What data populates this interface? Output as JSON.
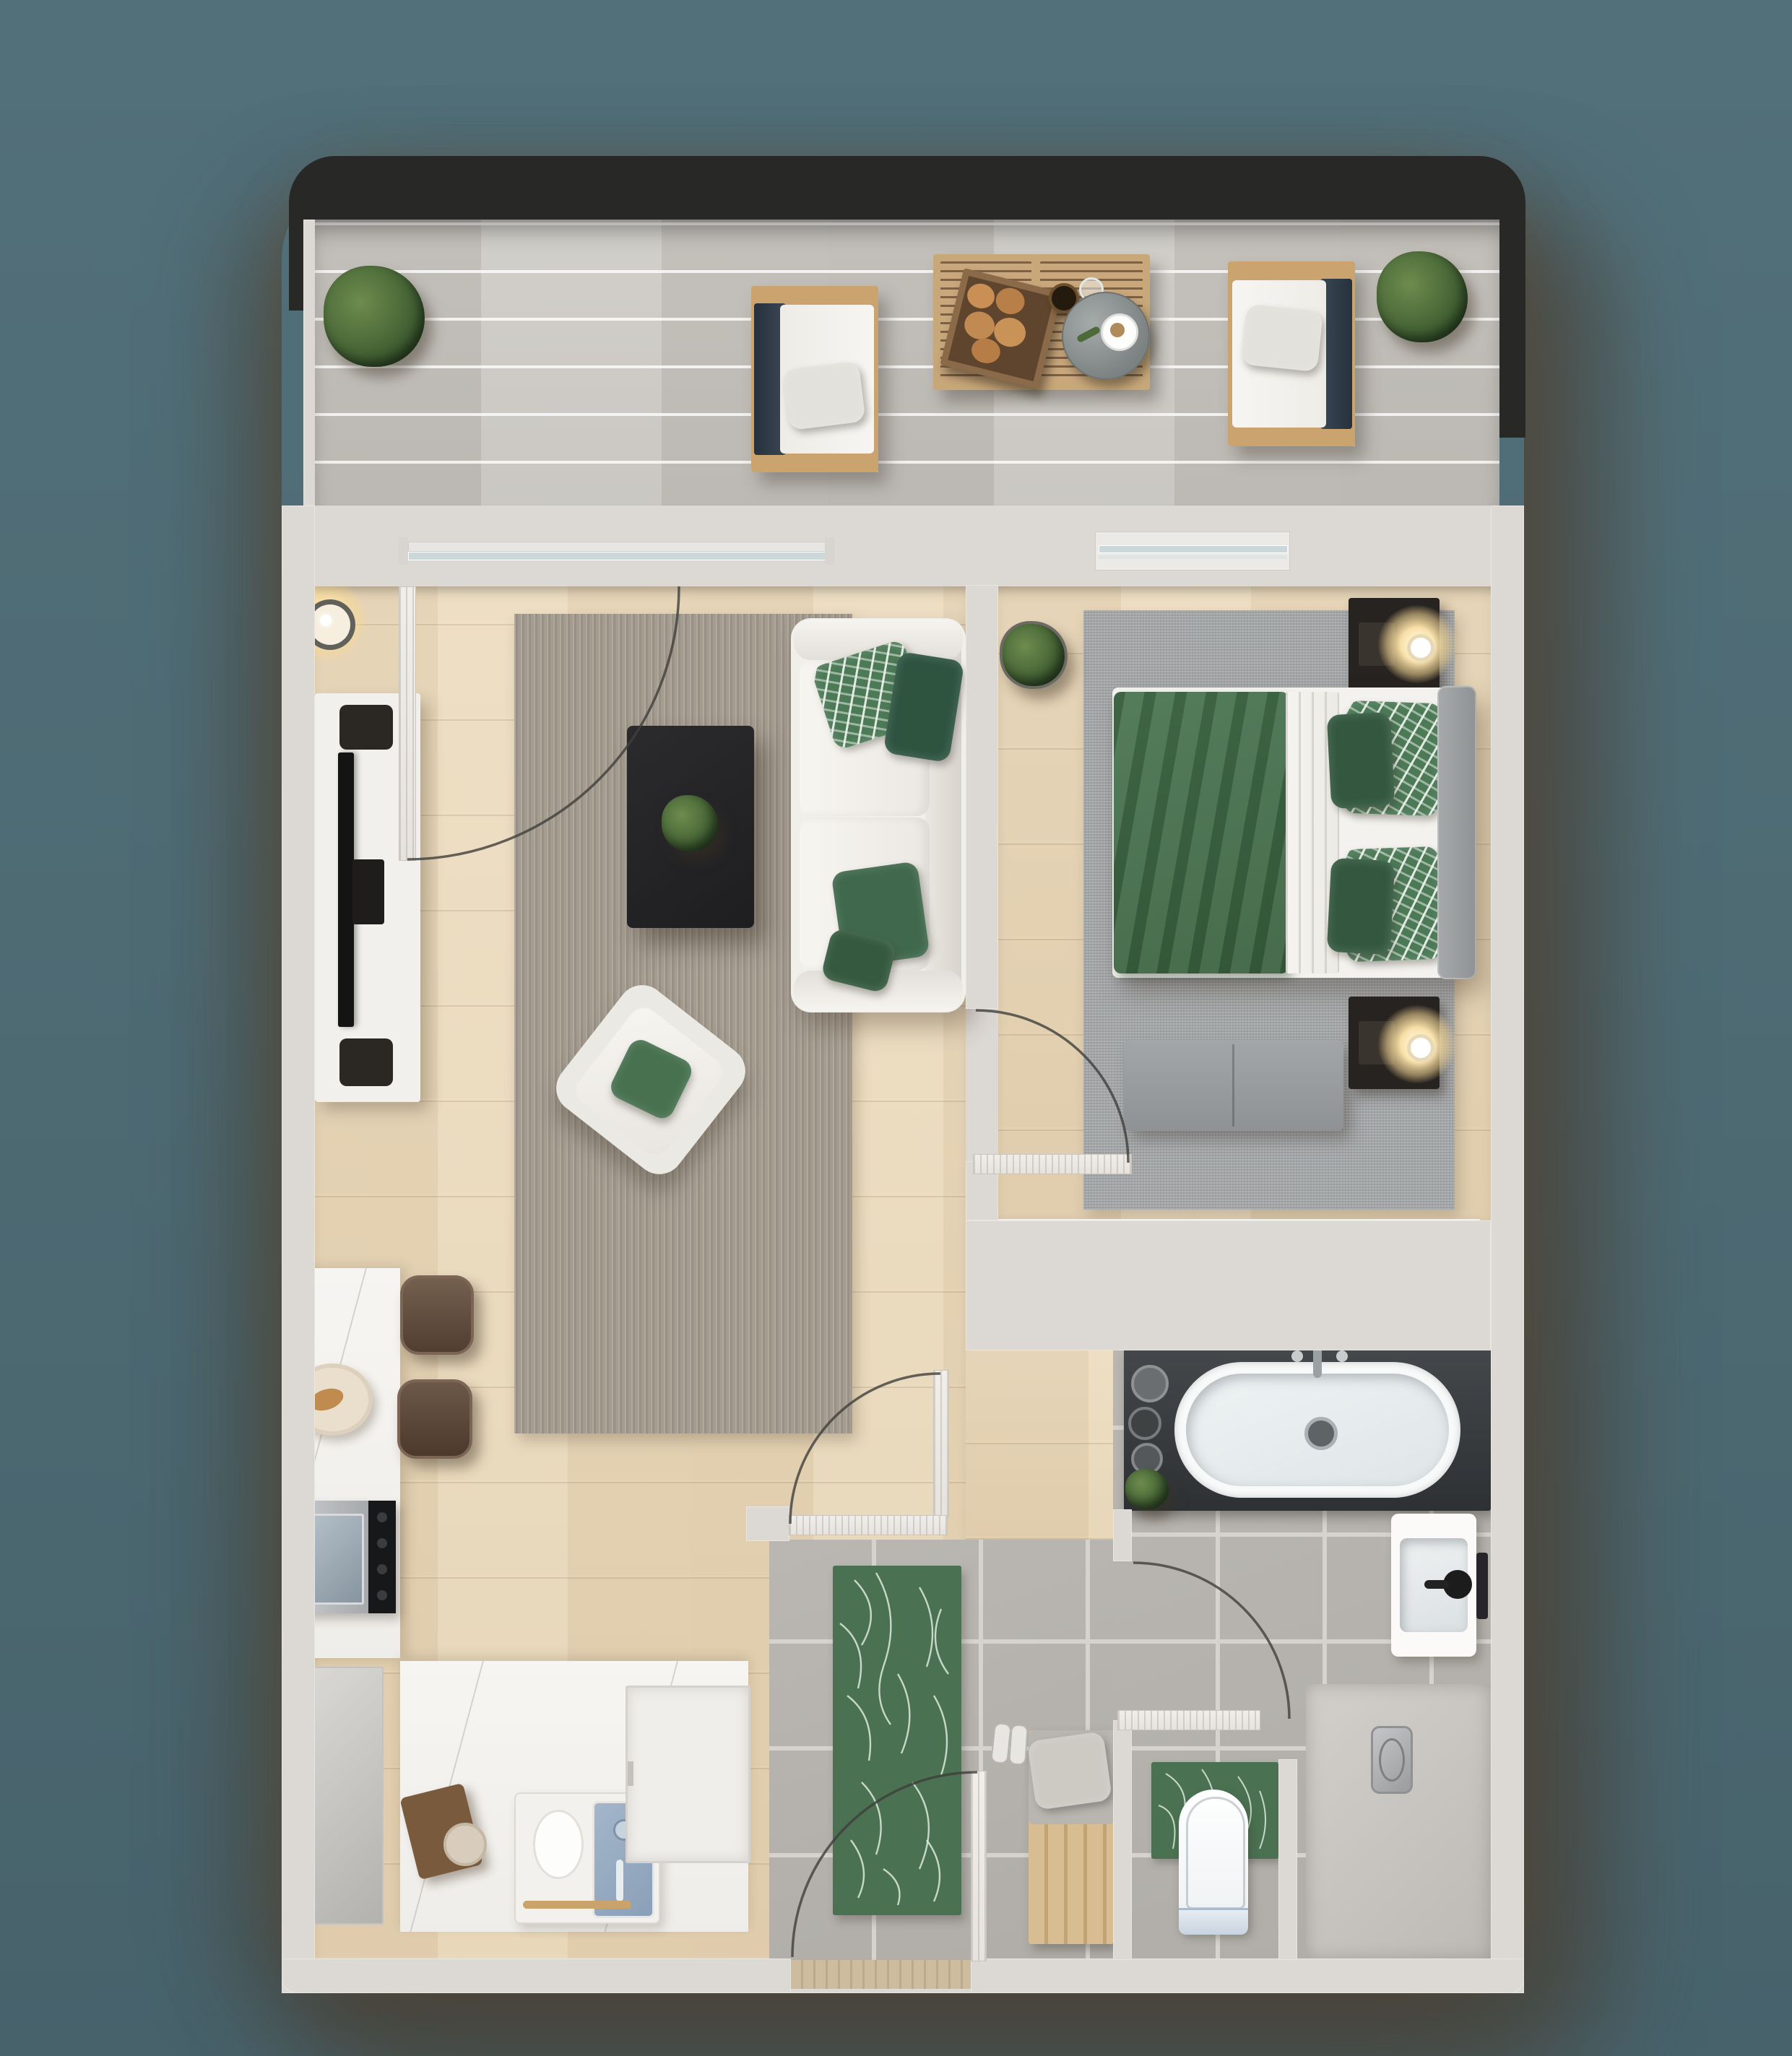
{
  "scene": {
    "type": "apartment floor plan, 3d rendered top-down view",
    "background_color": "#4e6b74",
    "wall_color": "#dcd8d4",
    "wood_floor_color": "#e8d7b8",
    "balcony_deck_color": "#c8c5c0",
    "tile_floor_color": "#b6b3ae",
    "accent_green": "#46714f",
    "dark_accent": "#27272a"
  },
  "rooms": [
    {
      "id": "balcony",
      "label": "Balcony",
      "items": [
        "potted plant",
        "lounge chair with white cushion",
        "slatted wood table with bread crate, bottle, glass and round serving tray with coffee cup",
        "second lounge chair",
        "second potted plant"
      ]
    },
    {
      "id": "living-room",
      "label": "Living room",
      "items": [
        "floor lamp",
        "white media console with tv and two speakers",
        "gray area rug",
        "black coffee table with potted plant",
        "white two-seat sofa with green and leaf-print pillows",
        "rotated white armchair with green pillow",
        "open balcony sliding door"
      ]
    },
    {
      "id": "bedroom",
      "label": "Bedroom",
      "items": [
        "potted plant",
        "nightstand with glowing lamp",
        "double bed with green duvet, white sheet, green and leaf-print pillows",
        "gray headboard",
        "gray bed-end bench",
        "second nightstand with glowing lamp",
        "gray area rug",
        "wardrobe with six slatted compartments",
        "window"
      ]
    },
    {
      "id": "kitchen",
      "label": "Kitchen",
      "items": [
        "marble counter",
        "breakfast plate with croissant",
        "two brown bar stools",
        "stainless range cooker",
        "refrigerator",
        "marble island counter",
        "cutting board",
        "small plate",
        "sink unit with blue basin and gold utensil",
        "dishwasher"
      ]
    },
    {
      "id": "hallway",
      "label": "Hallway",
      "items": [
        "green monstera runner rug",
        "wood entry bench with gray cushion and pillow",
        "pair of sneakers",
        "open entry door"
      ]
    },
    {
      "id": "bathroom",
      "label": "Bathroom",
      "items": [
        "oval bathtub on dark deck with chrome faucet",
        "toiletry bottles",
        "green plant",
        "white wash basin with black faucet",
        "wall towel bar",
        "toilet on green monstera mat",
        "shower area with drain"
      ]
    }
  ],
  "doors": [
    {
      "id": "balcony-slider",
      "label": "Balcony sliding door, open with swing arc"
    },
    {
      "id": "bedroom-door",
      "label": "Bedroom door, open with swing arc"
    },
    {
      "id": "hallway-door",
      "label": "Hallway door, open with swing arc"
    },
    {
      "id": "bathroom-door",
      "label": "Bathroom door, open with swing arc"
    },
    {
      "id": "entry-door",
      "label": "Apartment entry door, open with swing arc"
    }
  ],
  "windows": [
    {
      "id": "bedroom-window",
      "label": "Bedroom window"
    }
  ]
}
